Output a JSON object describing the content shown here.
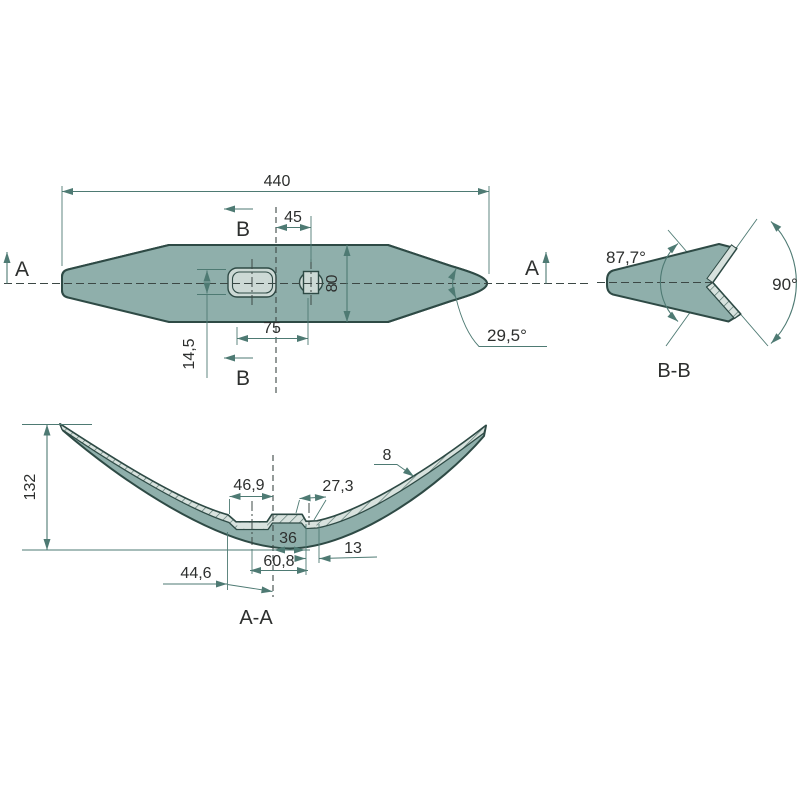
{
  "colors": {
    "background": "#ffffff",
    "part_fill": "#8fafab",
    "part_outline": "#2e4a45",
    "machined_fill": "#ccd9d5",
    "machined_light": "#d8e2de",
    "hatch_line": "#51706a",
    "dimension_line": "#4e7a73",
    "centerline": "#3c4845",
    "text": "#2d2f2e"
  },
  "top_view": {
    "overall_length": "440",
    "hole_offset": "45",
    "blade_width": "80",
    "hole_spacing": "75",
    "slot_offset": "14,5",
    "tip_angle": "29,5°",
    "section_a": "A",
    "section_b": "B"
  },
  "section_bb": {
    "title": "B-B",
    "inner_angle": "87,7°",
    "opening_angle": "90°"
  },
  "section_aa": {
    "title": "A-A",
    "overall_height": "132",
    "flat_left": "46,9",
    "flat_right": "27,3",
    "material_thickness": "8",
    "center_width": "36",
    "notch_width": "13",
    "hole_span": "60,8",
    "left_offset": "44,6"
  }
}
